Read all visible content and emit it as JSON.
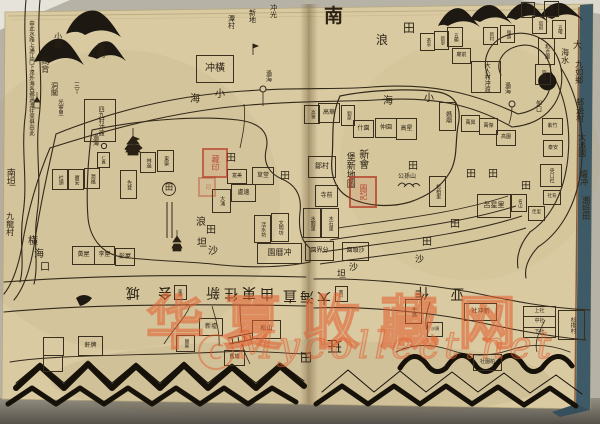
{
  "photo": {
    "paper_color": "#d9caa2",
    "ink_color": "#33291a",
    "cover_edge_color": "#3e5a66",
    "backdrop_color": "#b7b2a6",
    "seal_red": "#af301e",
    "watermark_orange": "#e26032"
  },
  "watermark": {
    "cn": "华夏收藏网",
    "latin": "Mycollect.net",
    "logo": "C"
  },
  "labels": [
    {
      "t": "南",
      "x": 324,
      "y": 6,
      "s": 19,
      "b": 1,
      "n": "compass-south-label"
    },
    {
      "t": "田",
      "x": 403,
      "y": 22,
      "s": 12
    },
    {
      "t": "浪",
      "x": 376,
      "y": 34,
      "s": 12
    },
    {
      "t": "小",
      "x": 215,
      "y": 90,
      "s": 10
    },
    {
      "t": "海",
      "x": 190,
      "y": 95,
      "s": 10
    },
    {
      "t": "海",
      "x": 383,
      "y": 97,
      "s": 10
    },
    {
      "t": "小",
      "x": 424,
      "y": 94,
      "s": 10
    },
    {
      "t": "冲光",
      "x": 269,
      "y": 4,
      "s": 7,
      "v": 1
    },
    {
      "t": "新地",
      "x": 248,
      "y": 9,
      "s": 7,
      "v": 1
    },
    {
      "t": "潭村",
      "x": 227,
      "y": 15,
      "s": 7,
      "v": 1
    },
    {
      "t": "過海",
      "x": 264,
      "y": 70,
      "s": 6,
      "v": 1,
      "n": "ferry-label"
    },
    {
      "t": "過海",
      "x": 503,
      "y": 82,
      "s": 6,
      "v": 1,
      "n": "ferry-label"
    },
    {
      "t": "過海",
      "x": 91,
      "y": 134,
      "s": 6,
      "v": 1,
      "n": "ferry-label"
    },
    {
      "t": "三丫",
      "x": 72,
      "y": 82,
      "s": 6,
      "v": 1
    },
    {
      "t": "小岡",
      "x": 53,
      "y": 32,
      "s": 8,
      "v": 1
    },
    {
      "t": "岡背",
      "x": 40,
      "y": 57,
      "s": 8,
      "v": 1
    },
    {
      "t": "龜岡",
      "x": 96,
      "y": 42,
      "s": 8,
      "v": 1
    },
    {
      "t": "洞閣",
      "x": 50,
      "y": 82,
      "s": 7,
      "v": 1
    },
    {
      "t": "光寧里",
      "x": 56,
      "y": 99,
      "s": 5.5,
      "v": 1
    },
    {
      "t": "田",
      "x": 226,
      "y": 154,
      "s": 10
    },
    {
      "t": "田",
      "x": 280,
      "y": 172,
      "s": 10
    },
    {
      "t": "田",
      "x": 165,
      "y": 184,
      "s": 8
    },
    {
      "t": "浪",
      "x": 196,
      "y": 218,
      "s": 10
    },
    {
      "t": "田",
      "x": 206,
      "y": 226,
      "s": 10
    },
    {
      "t": "坦",
      "x": 197,
      "y": 239,
      "s": 10
    },
    {
      "t": "沙",
      "x": 208,
      "y": 247,
      "s": 10
    },
    {
      "t": "橫",
      "x": 28,
      "y": 237,
      "s": 10
    },
    {
      "t": "海",
      "x": 34,
      "y": 250,
      "s": 10
    },
    {
      "t": "口",
      "x": 40,
      "y": 263,
      "s": 10
    },
    {
      "t": "南坦",
      "x": 4,
      "y": 168,
      "s": 9,
      "v": 1
    },
    {
      "t": "九龍村",
      "x": 5,
      "y": 212,
      "s": 8,
      "v": 1
    },
    {
      "t": "田",
      "x": 408,
      "y": 162,
      "s": 10
    },
    {
      "t": "田",
      "x": 466,
      "y": 170,
      "s": 10
    },
    {
      "t": "田",
      "x": 488,
      "y": 170,
      "s": 10
    },
    {
      "t": "田",
      "x": 521,
      "y": 182,
      "s": 10
    },
    {
      "t": "田",
      "x": 450,
      "y": 220,
      "s": 10
    },
    {
      "t": "田",
      "x": 422,
      "y": 238,
      "s": 10
    },
    {
      "t": "沙",
      "x": 349,
      "y": 264,
      "s": 9
    },
    {
      "t": "坦",
      "x": 337,
      "y": 271,
      "s": 9
    },
    {
      "t": "沙",
      "x": 415,
      "y": 256,
      "s": 9
    },
    {
      "t": "公孫山",
      "x": 398,
      "y": 174,
      "s": 6
    },
    {
      "t": "大",
      "x": 573,
      "y": 42,
      "s": 9
    },
    {
      "t": "海水",
      "x": 560,
      "y": 48,
      "s": 8,
      "v": 1
    },
    {
      "t": "九如鄉",
      "x": 574,
      "y": 60,
      "s": 8,
      "v": 1,
      "n": "margin-place-name"
    },
    {
      "t": "邨邊村",
      "x": 575,
      "y": 98,
      "s": 8,
      "v": 1,
      "n": "margin-place-name"
    },
    {
      "t": "大派園",
      "x": 577,
      "y": 133,
      "s": 8,
      "v": 1,
      "n": "margin-place-name"
    },
    {
      "t": "壇冲",
      "x": 579,
      "y": 170,
      "s": 8,
      "v": 1,
      "n": "margin-place-name"
    },
    {
      "t": "潮坦田",
      "x": 581,
      "y": 196,
      "s": 8,
      "v": 1,
      "n": "margin-place-name"
    },
    {
      "t": "夘口",
      "x": 534,
      "y": 100,
      "s": 6,
      "v": 1
    },
    {
      "t": "新會",
      "x": 356,
      "y": 149,
      "s": 10,
      "v": 1,
      "n": "map-title-column"
    },
    {
      "t": "堡新地圖",
      "x": 344,
      "y": 152,
      "s": 9,
      "v": 1,
      "n": "map-title-column"
    },
    {
      "t": "玨",
      "x": 327,
      "y": 338,
      "s": 15,
      "r": 1
    },
    {
      "t": "田",
      "x": 300,
      "y": 350,
      "s": 12,
      "r": 1
    },
    {
      "t": "由此水路上通江門下達外海各鄉過渡往來俱由此",
      "x": 27,
      "y": 20,
      "s": 5.5,
      "v": 1,
      "n": "route-annotation"
    }
  ],
  "phrase": {
    "size": 14,
    "chars": [
      {
        "t": "城",
        "x": 126,
        "y": 284
      },
      {
        "t": "会",
        "x": 158,
        "y": 284
      },
      {
        "t": "新",
        "x": 206,
        "y": 284
      },
      {
        "t": "往",
        "x": 224,
        "y": 285
      },
      {
        "t": "東",
        "x": 242,
        "y": 284
      },
      {
        "t": "由",
        "x": 260,
        "y": 285
      },
      {
        "t": "直",
        "x": 283,
        "y": 287
      },
      {
        "t": "海",
        "x": 300,
        "y": 288
      },
      {
        "t": "大",
        "x": 317,
        "y": 289
      },
      {
        "t": "作",
        "x": 415,
        "y": 284
      },
      {
        "t": "亚",
        "x": 450,
        "y": 285
      }
    ]
  },
  "seals": [
    {
      "x": 349,
      "y": 176,
      "w": 24,
      "h": 28,
      "chars": "圖記",
      "s": 8,
      "op": 0.9,
      "n": "red-seal-title"
    },
    {
      "x": 202,
      "y": 148,
      "w": 22,
      "h": 26,
      "chars": "藏印",
      "s": 8,
      "op": 0.85,
      "n": "red-seal-collector"
    },
    {
      "x": 198,
      "y": 177,
      "w": 14,
      "h": 16,
      "chars": "印",
      "s": 6,
      "op": 0.45,
      "n": "red-seal-small"
    }
  ],
  "villages": [
    {
      "x": 196,
      "y": 55,
      "w": 36,
      "h": 26,
      "t": "冲橫",
      "d": "h",
      "s": 10
    },
    {
      "x": 84,
      "y": 99,
      "w": 30,
      "h": 41,
      "t": "四九村冲渡",
      "s": 6
    },
    {
      "x": 52,
      "y": 169,
      "w": 14,
      "h": 19,
      "t": "社頭",
      "s": 5
    },
    {
      "x": 68,
      "y": 169,
      "w": 14,
      "h": 19,
      "t": "寶安",
      "s": 5
    },
    {
      "x": 84,
      "y": 168,
      "w": 14,
      "h": 19,
      "t": "潤福",
      "s": 5
    },
    {
      "x": 97,
      "y": 152,
      "w": 11,
      "h": 14,
      "t": "仁義",
      "s": 4
    },
    {
      "x": 140,
      "y": 152,
      "w": 14,
      "h": 19,
      "t": "林邊",
      "s": 5
    },
    {
      "x": 157,
      "y": 150,
      "w": 15,
      "h": 20,
      "t": "東榮",
      "s": 5
    },
    {
      "x": 120,
      "y": 170,
      "w": 15,
      "h": 27,
      "t": "先登",
      "s": 5
    },
    {
      "x": 72,
      "y": 246,
      "w": 21,
      "h": 17,
      "t": "黃屋",
      "d": "h",
      "s": 6
    },
    {
      "x": 94,
      "y": 246,
      "w": 19,
      "h": 17,
      "t": "李屋",
      "d": "h",
      "s": 6
    },
    {
      "x": 115,
      "y": 248,
      "w": 18,
      "h": 16,
      "t": "彭屋",
      "d": "h",
      "s": 6
    },
    {
      "x": 212,
      "y": 189,
      "w": 17,
      "h": 22,
      "t": "大涌",
      "s": 5
    },
    {
      "x": 231,
      "y": 184,
      "w": 23,
      "h": 16,
      "t": "盧邊",
      "d": "h",
      "s": 6
    },
    {
      "x": 252,
      "y": 167,
      "w": 20,
      "h": 16,
      "t": "草堂",
      "d": "h",
      "s": 6
    },
    {
      "x": 227,
      "y": 169,
      "w": 18,
      "h": 13,
      "t": "富美",
      "d": "h",
      "s": 5
    },
    {
      "x": 308,
      "y": 156,
      "w": 26,
      "h": 20,
      "t": "鄒村",
      "d": "h",
      "s": 7
    },
    {
      "x": 315,
      "y": 185,
      "w": 21,
      "h": 20,
      "t": "寺前",
      "d": "h",
      "s": 6
    },
    {
      "x": 303,
      "y": 208,
      "w": 16,
      "h": 28,
      "t": "水關里",
      "s": 5
    },
    {
      "x": 321,
      "y": 208,
      "w": 16,
      "h": 28,
      "t": "木石里",
      "s": 5
    },
    {
      "x": 254,
      "y": 215,
      "w": 15,
      "h": 26,
      "t": "活水坊",
      "s": 5
    },
    {
      "x": 271,
      "y": 213,
      "w": 16,
      "h": 27,
      "t": "文明坊",
      "s": 5
    },
    {
      "x": 257,
      "y": 243,
      "w": 43,
      "h": 19,
      "t": "園曆冲",
      "d": "h",
      "s": 8
    },
    {
      "x": 305,
      "y": 241,
      "w": 27,
      "h": 18,
      "t": "園界分",
      "d": "h",
      "s": 6
    },
    {
      "x": 342,
      "y": 242,
      "w": 25,
      "h": 17,
      "t": "園頭沙",
      "d": "h",
      "s": 6
    },
    {
      "x": 199,
      "y": 318,
      "w": 22,
      "h": 16,
      "t": "新墟",
      "d": "h",
      "s": 6
    },
    {
      "x": 252,
      "y": 320,
      "w": 27,
      "h": 17,
      "t": "松山",
      "d": "h",
      "s": 6
    },
    {
      "x": 224,
      "y": 350,
      "w": 19,
      "h": 14,
      "t": "舊墟",
      "d": "h",
      "s": 5
    },
    {
      "x": 78,
      "y": 336,
      "w": 23,
      "h": 18,
      "t": "軒牌",
      "d": "h",
      "s": 6
    },
    {
      "x": 43,
      "y": 337,
      "w": 19,
      "h": 17,
      "t": "",
      "d": "e"
    },
    {
      "x": 43,
      "y": 355,
      "w": 18,
      "h": 15,
      "t": "",
      "d": "e"
    },
    {
      "x": 176,
      "y": 335,
      "w": 17,
      "h": 15,
      "t": "朗尾",
      "s": 4.5
    },
    {
      "x": 174,
      "y": 285,
      "w": 11,
      "h": 13,
      "t": "渡頭",
      "s": 3.8
    },
    {
      "x": 335,
      "y": 286,
      "w": 11,
      "h": 14,
      "t": "閘口",
      "s": 3.8
    },
    {
      "x": 420,
      "y": 33,
      "w": 13,
      "h": 16,
      "t": "茶亭",
      "s": 4.5
    },
    {
      "x": 434,
      "y": 31,
      "w": 13,
      "h": 17,
      "t": "新寧",
      "s": 4.5
    },
    {
      "x": 447,
      "y": 27,
      "w": 14,
      "h": 18,
      "t": "五顯",
      "s": 4.5
    },
    {
      "x": 452,
      "y": 48,
      "w": 17,
      "h": 14,
      "t": "廟前",
      "d": "h",
      "s": 5
    },
    {
      "x": 483,
      "y": 27,
      "w": 13,
      "h": 16,
      "t": "新村",
      "s": 4.5
    },
    {
      "x": 500,
      "y": 25,
      "w": 13,
      "h": 16,
      "t": "嶺頭",
      "s": 4.5
    },
    {
      "x": 521,
      "y": 2,
      "w": 12,
      "h": 14,
      "t": "北坑",
      "s": 4
    },
    {
      "x": 544,
      "y": 1,
      "w": 13,
      "h": 14,
      "t": "鳳山",
      "s": 4
    },
    {
      "x": 552,
      "y": 20,
      "w": 12,
      "h": 17,
      "t": "五曜",
      "s": 4.5
    },
    {
      "x": 532,
      "y": 16,
      "w": 13,
      "h": 16,
      "t": "塔岡",
      "s": 4.5
    },
    {
      "x": 538,
      "y": 38,
      "w": 15,
      "h": 25,
      "t": "和合圍",
      "s": 5
    },
    {
      "x": 535,
      "y": 64,
      "w": 14,
      "h": 19,
      "t": "官田",
      "s": 5
    },
    {
      "x": 471,
      "y": 61,
      "w": 28,
      "h": 30,
      "t": "大人村冲渡",
      "s": 6
    },
    {
      "x": 439,
      "y": 102,
      "w": 15,
      "h": 27,
      "t": "媽廟",
      "s": 6
    },
    {
      "x": 461,
      "y": 115,
      "w": 17,
      "h": 15,
      "t": "萬興",
      "d": "h",
      "s": 5
    },
    {
      "x": 479,
      "y": 118,
      "w": 17,
      "h": 15,
      "t": "萬傑",
      "d": "h",
      "s": 5
    },
    {
      "x": 496,
      "y": 130,
      "w": 18,
      "h": 14,
      "t": "高園",
      "d": "h",
      "s": 5
    },
    {
      "x": 542,
      "y": 118,
      "w": 19,
      "h": 15,
      "t": "紫竹",
      "d": "h",
      "s": 5
    },
    {
      "x": 543,
      "y": 140,
      "w": 18,
      "h": 15,
      "t": "泰安",
      "d": "h",
      "s": 5
    },
    {
      "x": 540,
      "y": 164,
      "w": 20,
      "h": 21,
      "t": "央口社",
      "s": 5
    },
    {
      "x": 543,
      "y": 190,
      "w": 16,
      "h": 13,
      "t": "社背",
      "d": "h",
      "s": 4.5
    },
    {
      "x": 528,
      "y": 206,
      "w": 15,
      "h": 13,
      "t": "佳里",
      "d": "h",
      "s": 4.5
    },
    {
      "x": 429,
      "y": 176,
      "w": 15,
      "h": 29,
      "t": "松柏里",
      "s": 5
    },
    {
      "x": 477,
      "y": 194,
      "w": 32,
      "h": 22,
      "t": "呂星里",
      "d": "h",
      "s": 7
    },
    {
      "x": 511,
      "y": 194,
      "w": 14,
      "h": 16,
      "t": "名山",
      "s": 4.5
    },
    {
      "x": 304,
      "y": 105,
      "w": 14,
      "h": 17,
      "t": "高第",
      "s": 4.5
    },
    {
      "x": 318,
      "y": 103,
      "w": 20,
      "h": 18,
      "t": "高華",
      "d": "h",
      "s": 6
    },
    {
      "x": 341,
      "y": 105,
      "w": 12,
      "h": 19,
      "t": "劉屋",
      "s": 4.5
    },
    {
      "x": 353,
      "y": 120,
      "w": 19,
      "h": 16,
      "t": "什園",
      "d": "h",
      "s": 6
    },
    {
      "x": 375,
      "y": 118,
      "w": 20,
      "h": 18,
      "t": "仲園",
      "d": "h",
      "s": 6
    },
    {
      "x": 396,
      "y": 118,
      "w": 19,
      "h": 20,
      "t": "高星",
      "d": "h",
      "s": 6
    },
    {
      "x": 464,
      "y": 303,
      "w": 31,
      "h": 16,
      "t": "社冲新",
      "d": "h",
      "s": 6
    },
    {
      "x": 523,
      "y": 306,
      "w": 31,
      "h": 30,
      "d": "g",
      "rows": [
        "上社",
        "中社",
        "下社"
      ],
      "s": 5
    },
    {
      "x": 558,
      "y": 310,
      "w": 25,
      "h": 28,
      "t": "杉排村",
      "s": 5.5
    },
    {
      "x": 405,
      "y": 299,
      "w": 15,
      "h": 23,
      "t": "牛路",
      "s": 5
    },
    {
      "x": 473,
      "y": 354,
      "w": 27,
      "h": 15,
      "t": "社園柏",
      "d": "h",
      "s": 5
    },
    {
      "x": 427,
      "y": 322,
      "w": 14,
      "h": 13,
      "t": "沙頭",
      "d": "h",
      "s": 4
    }
  ]
}
